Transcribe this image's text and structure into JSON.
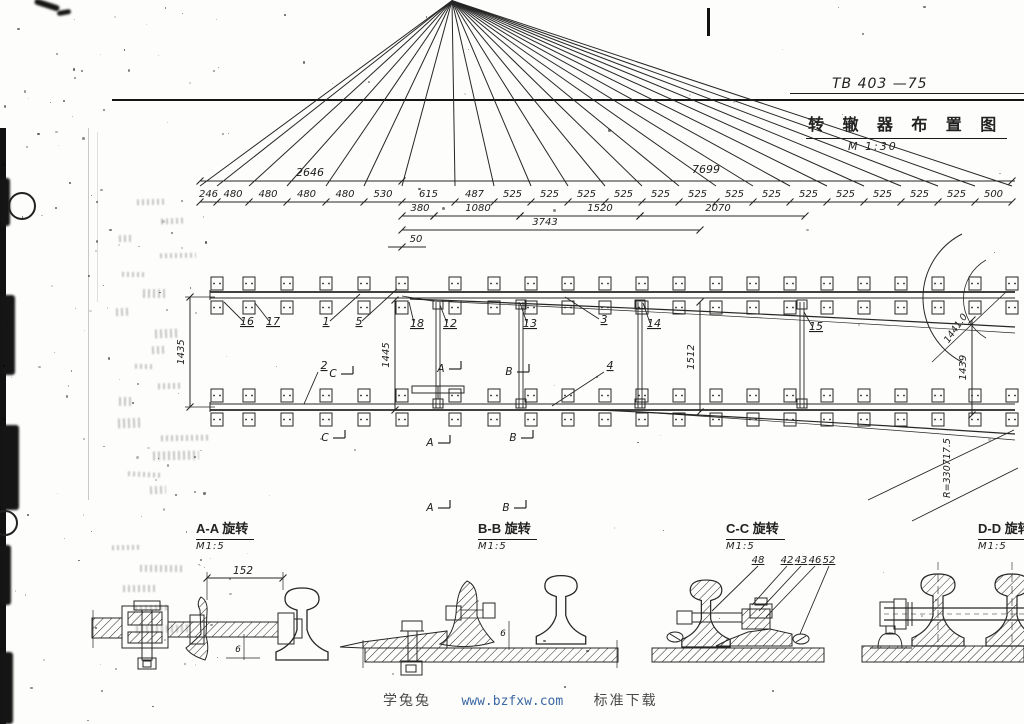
{
  "page": {
    "code_label": "TB 403 —75"
  },
  "title_block": {
    "title": "转 辙 器 布 置 图",
    "scale": "M 1:30"
  },
  "plan": {
    "overall_dims": [
      "2646",
      "7699"
    ],
    "segment_dims": [
      "246",
      "480",
      "480",
      "480",
      "480",
      "530",
      "615",
      "487",
      "525",
      "525",
      "525",
      "525",
      "525",
      "525",
      "525",
      "525",
      "525",
      "525",
      "525",
      "525",
      "525",
      "500"
    ],
    "sub_dims": [
      "380",
      "1080",
      "1520",
      "2070",
      "3743",
      "50"
    ],
    "vertical_dims": [
      "1435",
      "1445",
      "1512",
      "1439"
    ],
    "diagonal_dim": "1441.0",
    "radius_label": "R=330717.5",
    "part_labels": [
      "16",
      "17",
      "1",
      "5",
      "18",
      "12",
      "13",
      "3",
      "14",
      "4",
      "2",
      "15"
    ],
    "section_letters": [
      "C",
      "A",
      "B"
    ]
  },
  "sections": [
    {
      "title": "A-A 旋转",
      "scale": "M1:5",
      "dims": [
        "152",
        "6"
      ]
    },
    {
      "title": "B-B 旋转",
      "scale": "M1:5",
      "dims": [
        "6"
      ]
    },
    {
      "title": "C-C 旋转",
      "scale": "M1:5",
      "labels": [
        "48",
        "42",
        "43",
        "46",
        "52"
      ]
    },
    {
      "title": "D-D 旋转",
      "scale": "M1:5"
    }
  ],
  "watermark": {
    "site": "学兔兔",
    "url": "www.bzfxw.com",
    "tagline": "标准下载"
  },
  "colors": {
    "ink": "#222222",
    "url_blue": "#3a67a3"
  }
}
